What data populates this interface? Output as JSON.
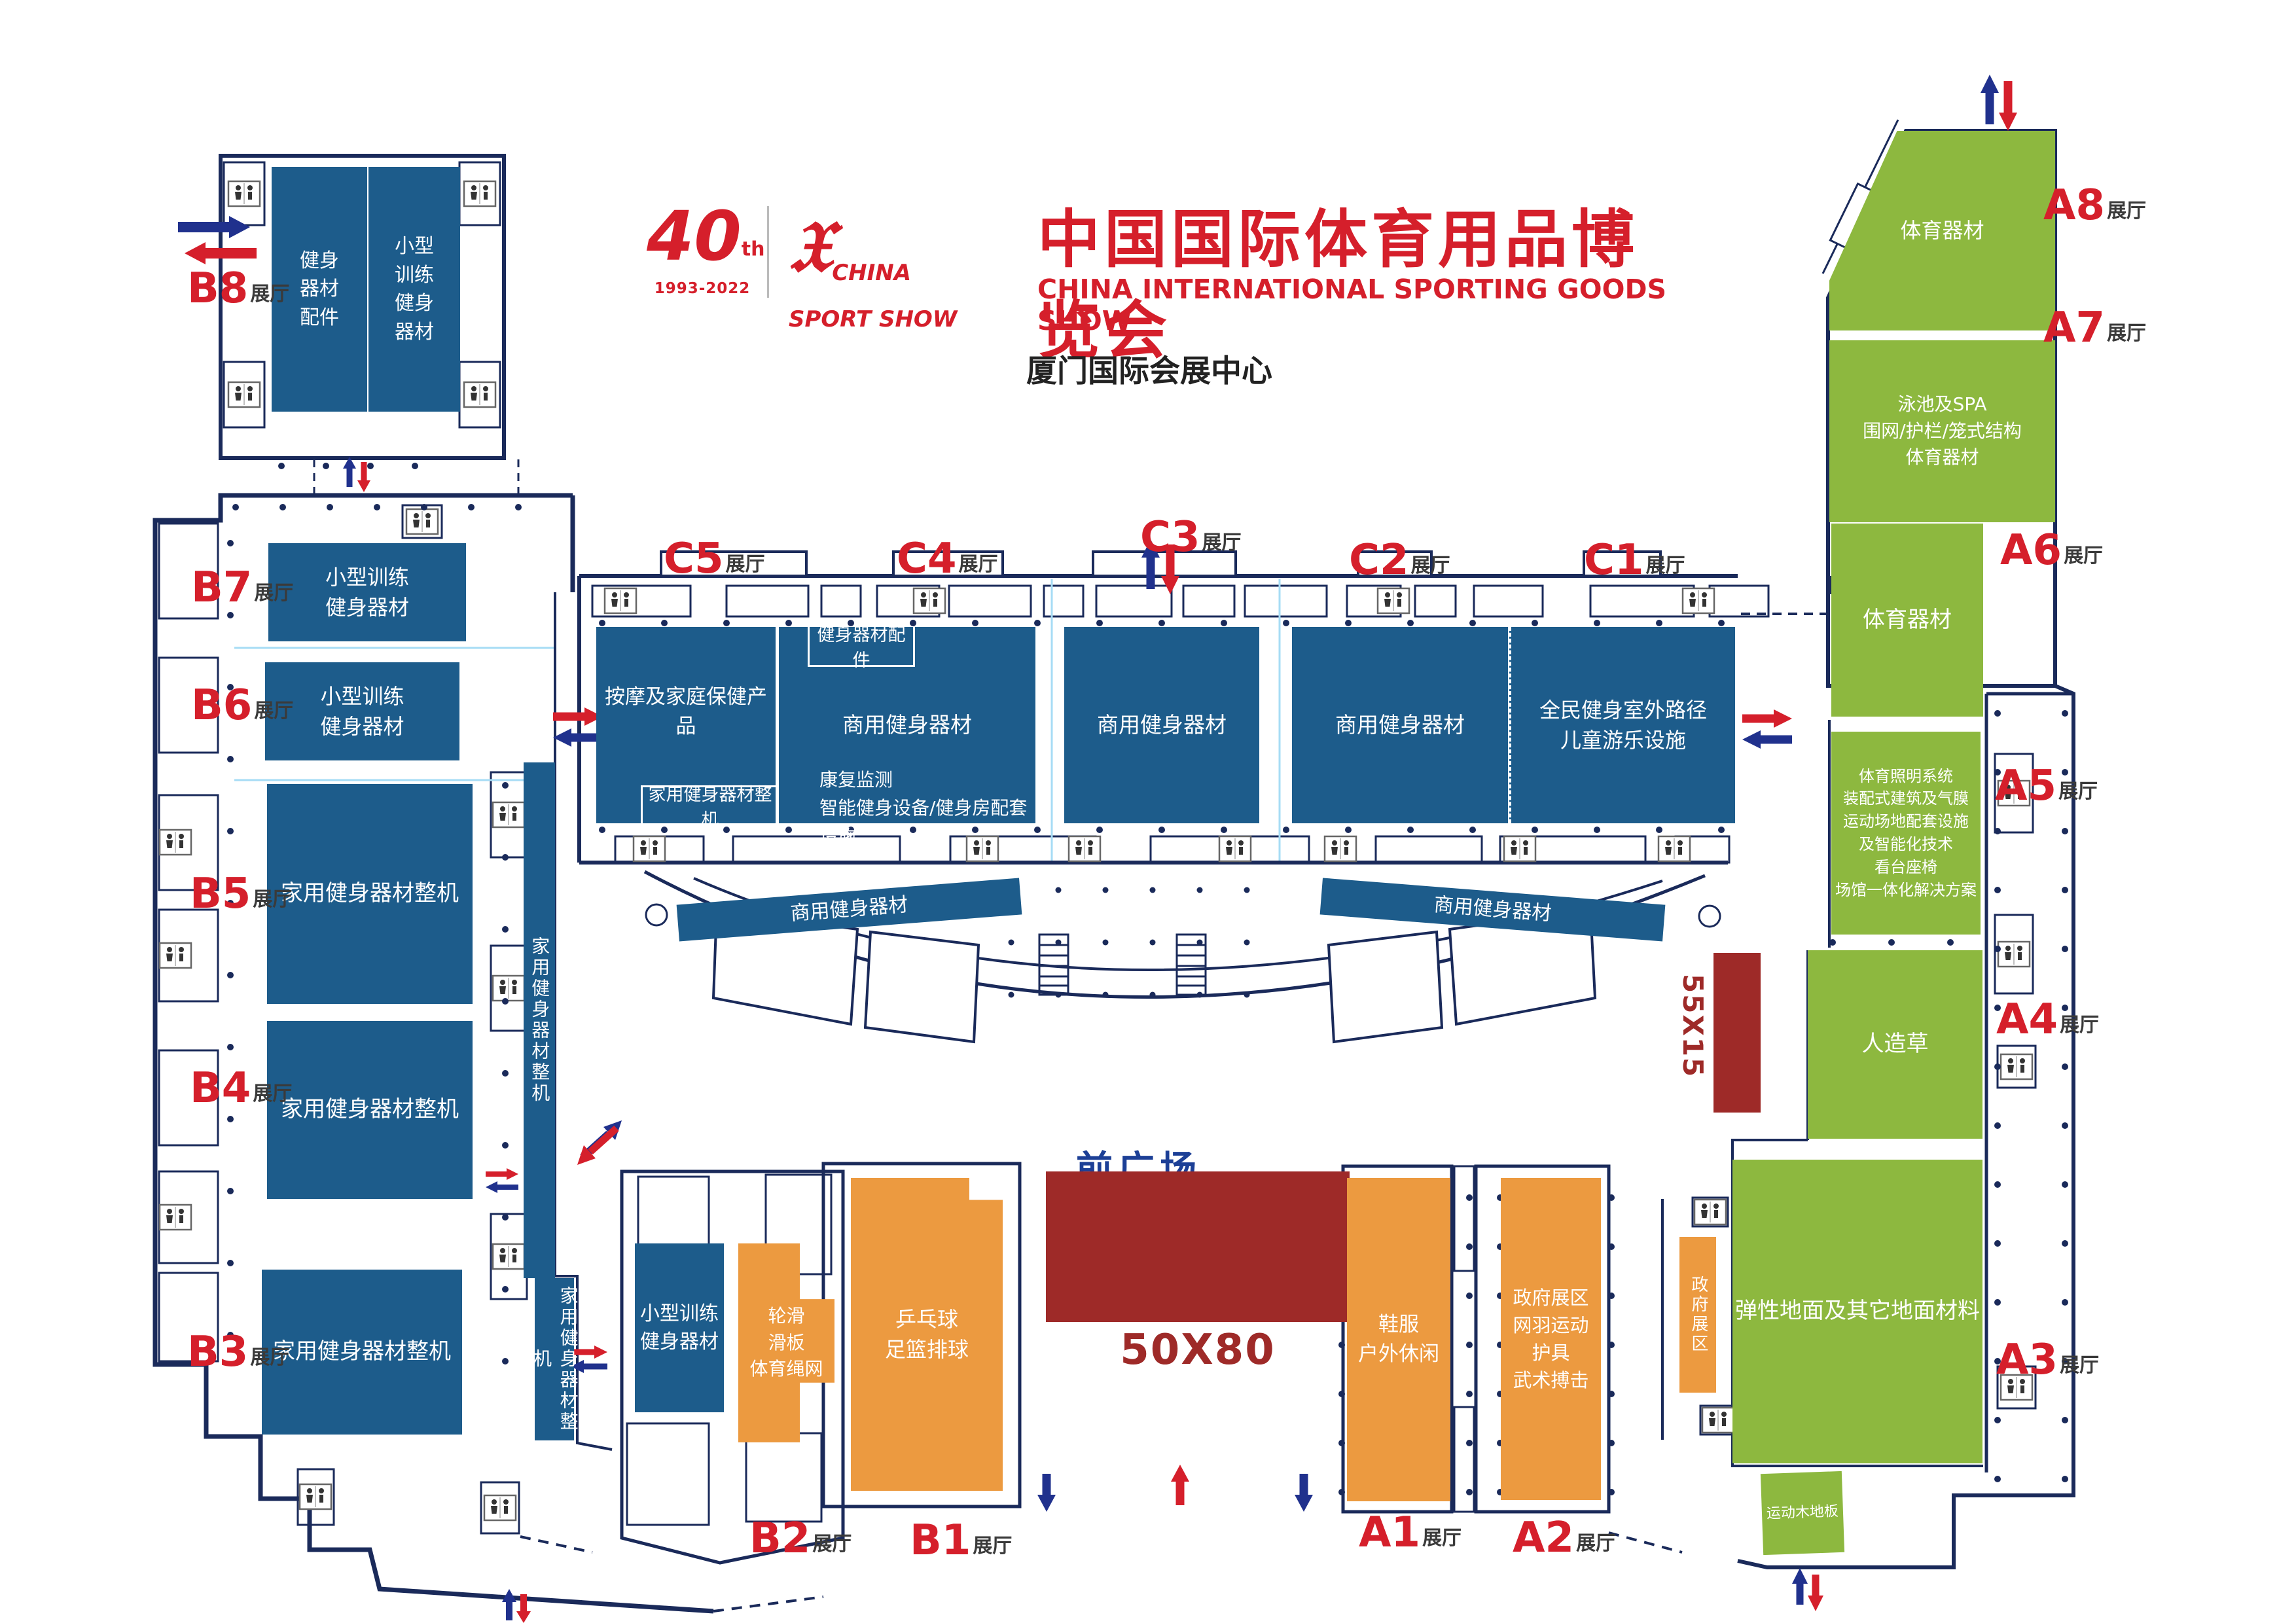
{
  "header": {
    "anniversary_number": "40",
    "anniversary_suffix": "th",
    "anniversary_years": "1993-2022",
    "logo_line1": "CHINA",
    "logo_line2": "SPORT SHOW",
    "logo_glyph": "china-sport-show-figure",
    "title": "中国国际体育用品博览会",
    "subtitle": "CHINA INTERNATIONAL SPORTING GOODS SHOW",
    "venue": "厦门国际会展中心"
  },
  "markers": {
    "b8": {
      "num": "B8",
      "suffix": "展厅"
    },
    "b7": {
      "num": "B7",
      "suffix": "展厅"
    },
    "b6": {
      "num": "B6",
      "suffix": "展厅"
    },
    "b5": {
      "num": "B5",
      "suffix": "展厅"
    },
    "b4": {
      "num": "B4",
      "suffix": "展厅"
    },
    "b3": {
      "num": "B3",
      "suffix": "展厅"
    },
    "b2": {
      "num": "B2",
      "suffix": "展厅"
    },
    "b1": {
      "num": "B1",
      "suffix": "展厅"
    },
    "c5": {
      "num": "C5",
      "suffix": "展厅"
    },
    "c4": {
      "num": "C4",
      "suffix": "展厅"
    },
    "c3": {
      "num": "C3",
      "suffix": "展厅"
    },
    "c2": {
      "num": "C2",
      "suffix": "展厅"
    },
    "c1": {
      "num": "C1",
      "suffix": "展厅"
    },
    "a1": {
      "num": "A1",
      "suffix": "展厅"
    },
    "a2": {
      "num": "A2",
      "suffix": "展厅"
    },
    "a3": {
      "num": "A3",
      "suffix": "展厅"
    },
    "a4": {
      "num": "A4",
      "suffix": "展厅"
    },
    "a5": {
      "num": "A5",
      "suffix": "展厅"
    },
    "a6": {
      "num": "A6",
      "suffix": "展厅"
    },
    "a7": {
      "num": "A7",
      "suffix": "展厅"
    },
    "a8": {
      "num": "A8",
      "suffix": "展厅"
    }
  },
  "blocks": {
    "b8_left": "健身\n器材\n配件",
    "b8_right": "小型\n训练\n健身\n器材",
    "b7": "小型训练\n健身器材",
    "b6": "小型训练\n健身器材",
    "b5": "家用健身器材整机",
    "b4": "家用健身器材整机",
    "b3": "家用健身器材整机",
    "b_strip_upper": "家用健身器材整机",
    "b_strip_lower": "家用健身器材整机",
    "b2_blue": "小型训练\n健身器材",
    "b2_orange": "轮滑\n滑板\n体育绳网",
    "b1": "乒乓球\n足篮排球",
    "c5": "按摩及家庭保健产品",
    "c5_sub": "家用健身器材整机",
    "c4_top": "健身器材配件",
    "c4": "商用健身器材",
    "c4_sub": "康复监测\n智能健身设备/健身房配套设施",
    "c3": "商用健身器材",
    "c2": "商用健身器材",
    "c1": "全民健身室外路径\n儿童游乐设施",
    "strip_left": "商用健身器材",
    "strip_right": "商用健身器材",
    "a1": "鞋服\n户外休闲",
    "a2": "政府展区\n网羽运动\n护具\n武术搏击",
    "gov": "政府展区",
    "a3": "弹性地面及其它地面材料",
    "a4": "人造草",
    "a5": "体育照明系统\n装配式建筑及气膜\n运动场地配套设施\n及智能化技术\n看台座椅\n场馆一体化解决方案",
    "a6": "体育器材",
    "a7": "泳池及SPA\n围网/护栏/笼式结构\n体育器材",
    "a8": "体育器材",
    "wood": "运动木地板"
  },
  "plaza": {
    "label": "前广场",
    "stage_size": "50X80",
    "side_size": "55X15"
  },
  "colors": {
    "hall_blue": "#1d5c8b",
    "hall_green": "#8db83f",
    "hall_orange": "#ec9a40",
    "stage_red": "#9e2a28",
    "marker_red": "#d51f2b",
    "wall_navy": "#1a2a5a",
    "arrow_blue": "#20318d",
    "arrow_red": "#d51f2b",
    "plaza_text_blue": "#1c3f96"
  }
}
